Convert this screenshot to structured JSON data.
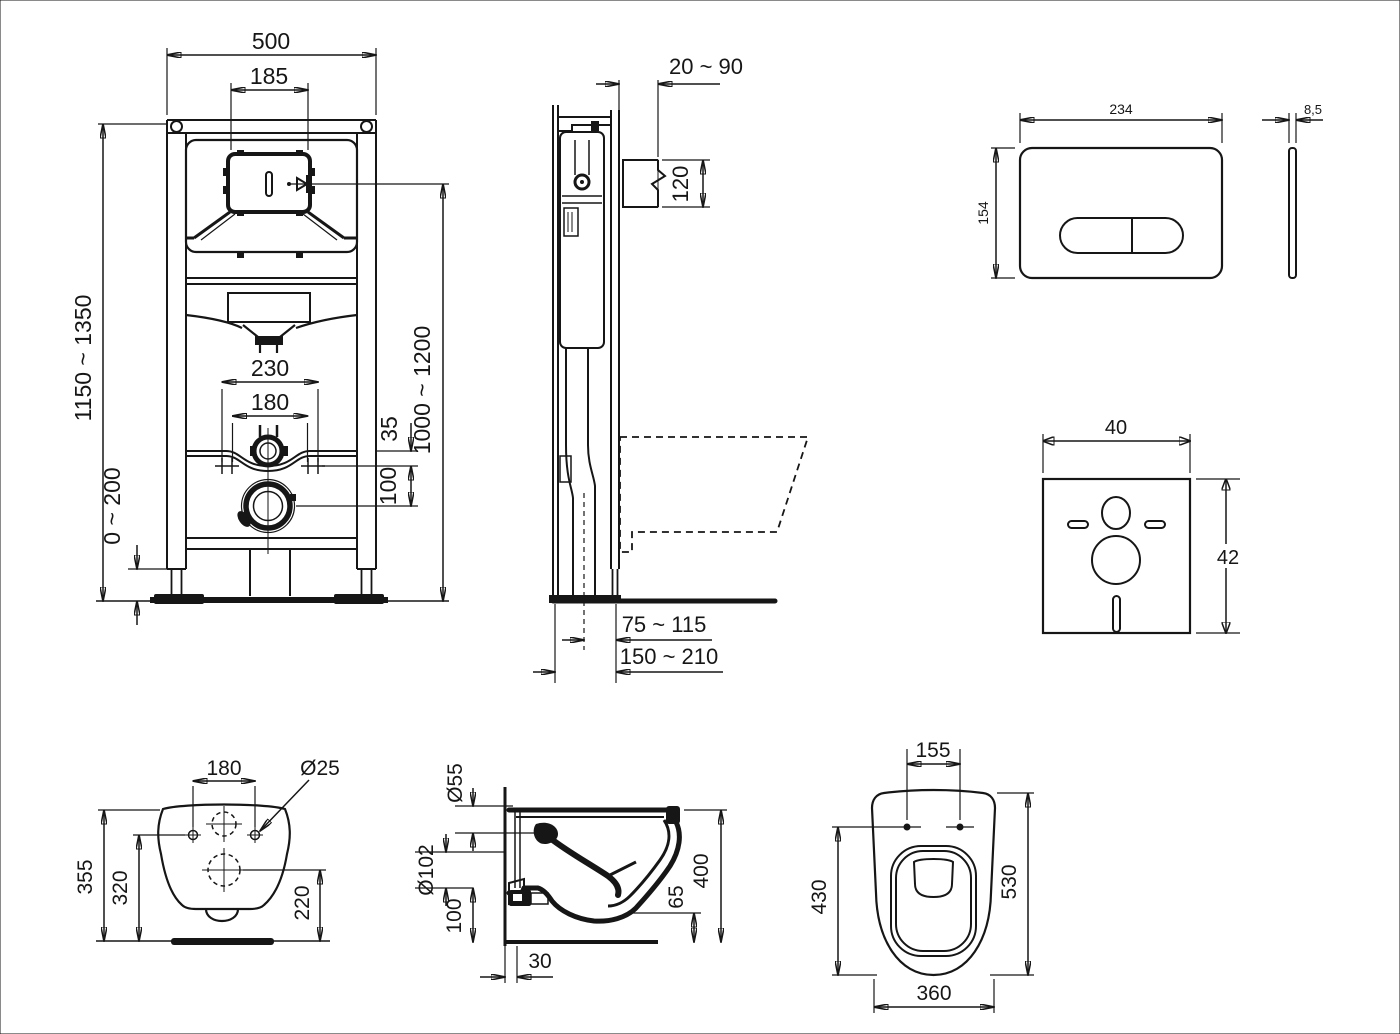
{
  "drawing": {
    "background": "#fafafa",
    "line_color": "#161616"
  },
  "frame_front": {
    "overall_width": "500",
    "service_opening": "185",
    "height_left": "1150 ~ 1350",
    "height_right": "1000 ~ 1200",
    "fixing_outer": "230",
    "fixing_inner": "180",
    "rail_offset": "35",
    "drain_offset": "100",
    "foot_adjust": "0 ~ 200"
  },
  "frame_side": {
    "wall_distance": "20 ~ 90",
    "connector_height": "120",
    "outlet_axis": "75 ~ 115",
    "total_depth": "150 ~ 210"
  },
  "flush_plate": {
    "width": "234",
    "height": "154",
    "thickness": "8,5"
  },
  "sound_mat": {
    "width": "40",
    "height": "42"
  },
  "pan_rear": {
    "hole_spacing": "180",
    "hole_diameter": "Ø25",
    "total_height": "355",
    "hole_height": "320",
    "outlet_height": "220"
  },
  "pan_side": {
    "inlet_diameter": "Ø55",
    "outlet_diameter": "Ø102",
    "outlet_bottom_height": "100",
    "wall_gap": "30",
    "front_bottom_height": "65",
    "total_depth": "400"
  },
  "pan_top": {
    "seat_hole_spacing": "155",
    "hole_to_front": "430",
    "total_depth": "530",
    "width": "360"
  }
}
